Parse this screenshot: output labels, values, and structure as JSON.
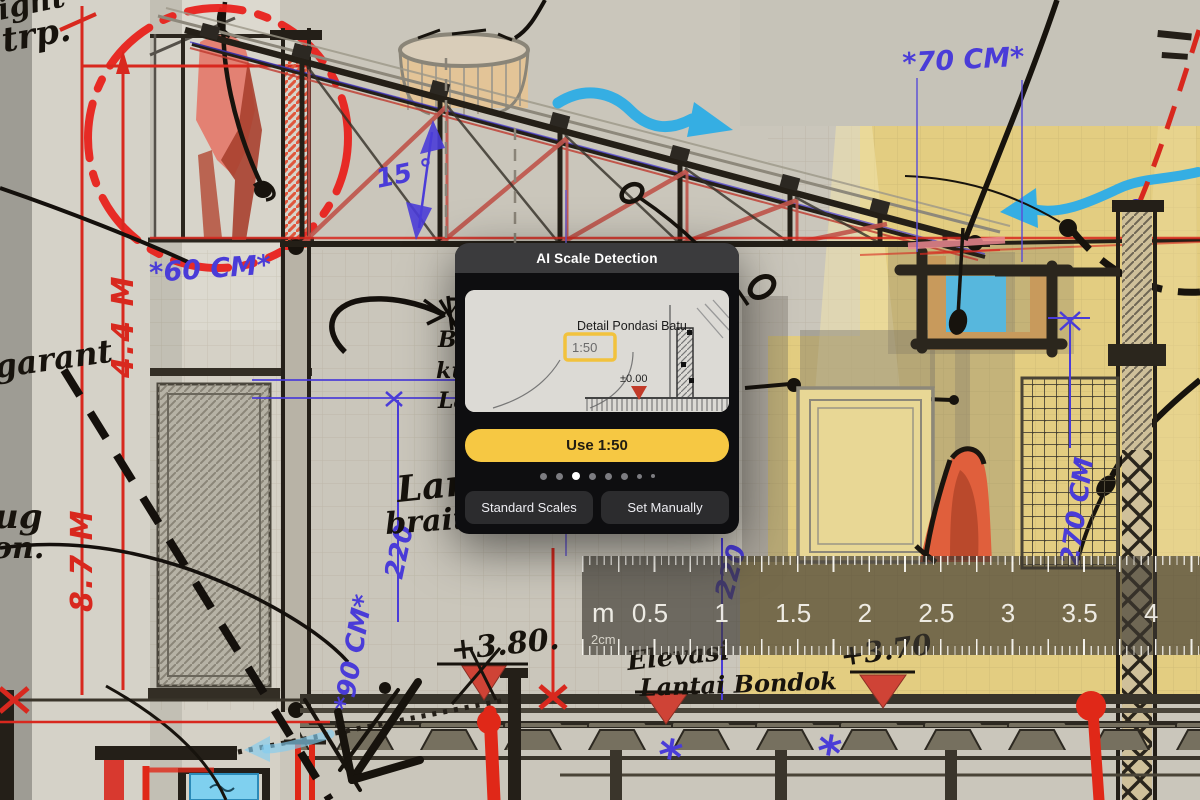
{
  "dialog": {
    "title": "AI Scale Detection",
    "preview": {
      "drawing_title": "Detail Pondasi Batu",
      "scale_label": "1:50",
      "elevation_label": "±0.00"
    },
    "use_button": "Use 1:50",
    "page_dots": {
      "count": 8,
      "active_index": 2
    },
    "standard_scales_button": "Standard Scales",
    "set_manually_button": "Set Manually"
  },
  "ruler": {
    "unit_label": "m",
    "scale_label": "2cm",
    "tick_labels": [
      "0.5",
      "1",
      "1.5",
      "2",
      "2.5",
      "3",
      "3.5",
      "4"
    ]
  },
  "annotations": {
    "dim_60cm": "*60 CM*",
    "dim_70cm": "*70 CM*",
    "angle_15": "15 °",
    "dim_220_left": "220",
    "dim_90cm": "*90 CM*",
    "dim_220_mid": "220",
    "dim_270cm": "270 CM",
    "dim_44m": "4.4 M",
    "dim_87m": "8.7 M",
    "elev_380": "+3.80.",
    "elev_370": "+3.70",
    "note_elevasi": "Elevasi",
    "note_lantai": "Lantai Bondok",
    "note_ight": "ight",
    "note_trp": "trp.",
    "note_garant": "garant",
    "note_ug": "ug",
    "note_on": "on.",
    "note_lan": "Lan",
    "note_brait": "brait,",
    "frag_7": "7",
    "frag_ba": "Ba",
    "frag_ku": "ku",
    "frag_la": "La"
  },
  "colors": {
    "accent_yellow": "#f6c843",
    "ink_blue": "#4a3cd8",
    "ink_red": "#d8281e",
    "canvas_yellow": "#e3cd81"
  }
}
